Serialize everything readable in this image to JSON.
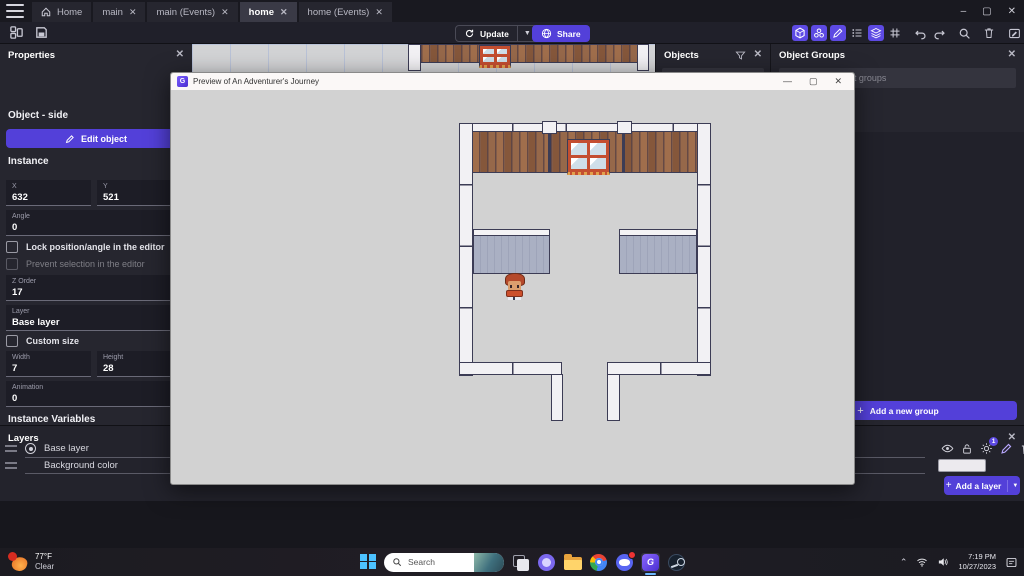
{
  "colors": {
    "accent": "#5340d9",
    "toggle_on": "#5d4ae3",
    "panel": "#26262f",
    "canvas": "#d2d3d5"
  },
  "tabbar": {
    "tabs": [
      {
        "label": "Home"
      },
      {
        "label": "main"
      },
      {
        "label": "main (Events)"
      },
      {
        "label": "home"
      },
      {
        "label": "home (Events)"
      }
    ]
  },
  "toolbar": {
    "update_label": "Update",
    "share_label": "Share"
  },
  "properties": {
    "title": "Properties",
    "object_heading": "Object  - side",
    "edit_object": "Edit object",
    "instance": "Instance",
    "x_label": "X",
    "x_value": "632",
    "y_label": "Y",
    "y_value": "521",
    "angle_label": "Angle",
    "angle_value": "0",
    "lock_label": "Lock position/angle in the editor",
    "prevent_label": "Prevent selection in the editor",
    "zorder_label": "Z Order",
    "zorder_value": "17",
    "layer_label": "Layer",
    "layer_value": "Base layer",
    "custom_size_label": "Custom size",
    "width_label": "Width",
    "width_value": "7",
    "height_label": "Height",
    "height_value": "28",
    "animation_label": "Animation",
    "animation_value": "0",
    "instance_variables": "Instance Variables",
    "search_variables_placeholder": "Search variables"
  },
  "objects_panel": {
    "title": "Objects",
    "search_placeholder": "Search objects"
  },
  "object_groups_panel": {
    "title": "Object Groups",
    "search_placeholder": "Search object groups",
    "add_group": "Add a new group"
  },
  "layers_panel": {
    "title": "Layers",
    "rows": [
      {
        "name": "Base layer"
      },
      {
        "name": "Background color"
      }
    ],
    "effects_badge": "1",
    "add_layer": "Add a layer"
  },
  "preview": {
    "title": "Preview of An Adventurer's Journey"
  },
  "taskbar": {
    "weather_temp": "77°F",
    "weather_condition": "Clear",
    "search_placeholder": "Search",
    "time": "7:19 PM",
    "date": "10/27/2023"
  }
}
